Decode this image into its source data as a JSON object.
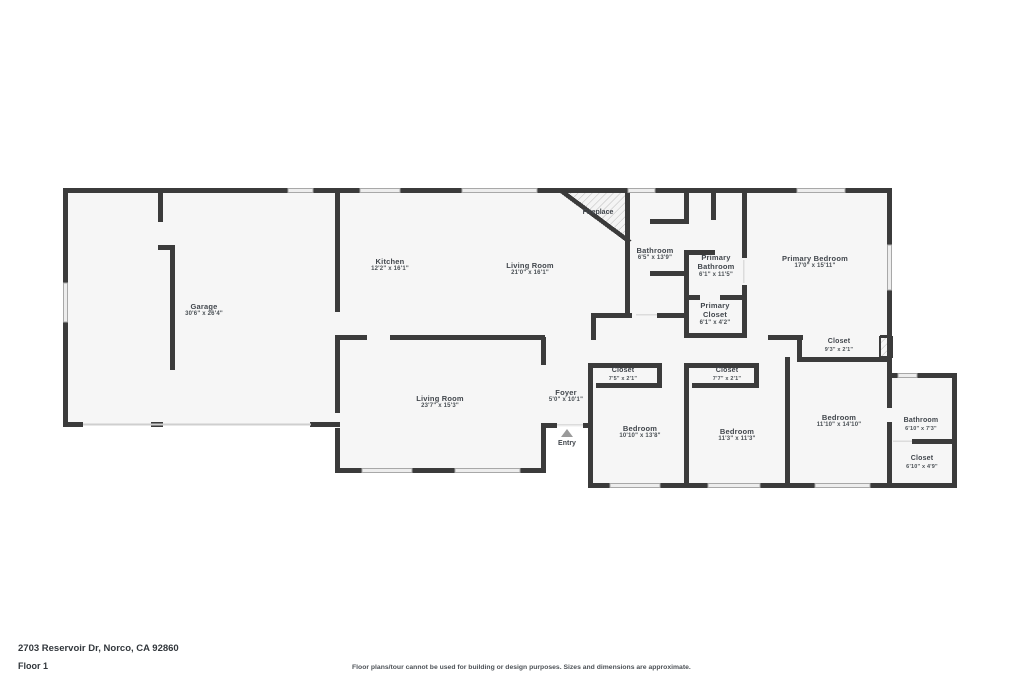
{
  "plan": {
    "rooms": {
      "garage": {
        "name": "Garage",
        "dims": "30'6\" x 26'4\""
      },
      "kitchen": {
        "name": "Kitchen",
        "dims": "12'2\" x 16'1\""
      },
      "living_room": {
        "name": "Living Room",
        "dims": "21'0\" x 16'1\""
      },
      "bathroom": {
        "name": "Bathroom",
        "dims": "6'5\" x 13'9\""
      },
      "primary_bathroom": {
        "name": "Primary Bathroom",
        "dims": "6'1\" x 11'5\""
      },
      "primary_closet": {
        "name": "Primary Closet",
        "dims": "6'1\" x 4'2\""
      },
      "primary_bedroom": {
        "name": "Primary Bedroom",
        "dims": "17'0\" x 15'11\""
      },
      "closet_primary": {
        "name": "Closet",
        "dims": "9'3\" x 2'1\""
      },
      "living_room_2": {
        "name": "Living Room",
        "dims": "23'7\" x 15'3\""
      },
      "foyer": {
        "name": "Foyer",
        "dims": "5'0\" x 10'1\""
      },
      "closet_a": {
        "name": "Closet",
        "dims": "7'5\" x 2'1\""
      },
      "closet_b": {
        "name": "Closet",
        "dims": "7'7\" x 2'1\""
      },
      "bedroom_a": {
        "name": "Bedroom",
        "dims": "10'10\" x 13'8\""
      },
      "bedroom_b": {
        "name": "Bedroom",
        "dims": "11'3\" x 11'3\""
      },
      "bedroom_c": {
        "name": "Bedroom",
        "dims": "11'10\" x 14'10\""
      },
      "bathroom_2": {
        "name": "Bathroom",
        "dims": "6'10\" x 7'3\""
      },
      "closet_c": {
        "name": "Closet",
        "dims": "6'10\" x 4'9\""
      }
    },
    "fireplace_label": "Fireplace",
    "entry_label": "Entry"
  },
  "footer": {
    "address": "2703 Reservoir Dr, Norco, CA 92860",
    "floor": "Floor 1",
    "disclaimer": "Floor plans/tour cannot be used for building or design purposes. Sizes and dimensions are approximate."
  },
  "colors": {
    "wall": "#3b3b3b",
    "floor_fill": "#f6f6f6",
    "window_fill": "#ededed",
    "label_text": "#42474d"
  }
}
